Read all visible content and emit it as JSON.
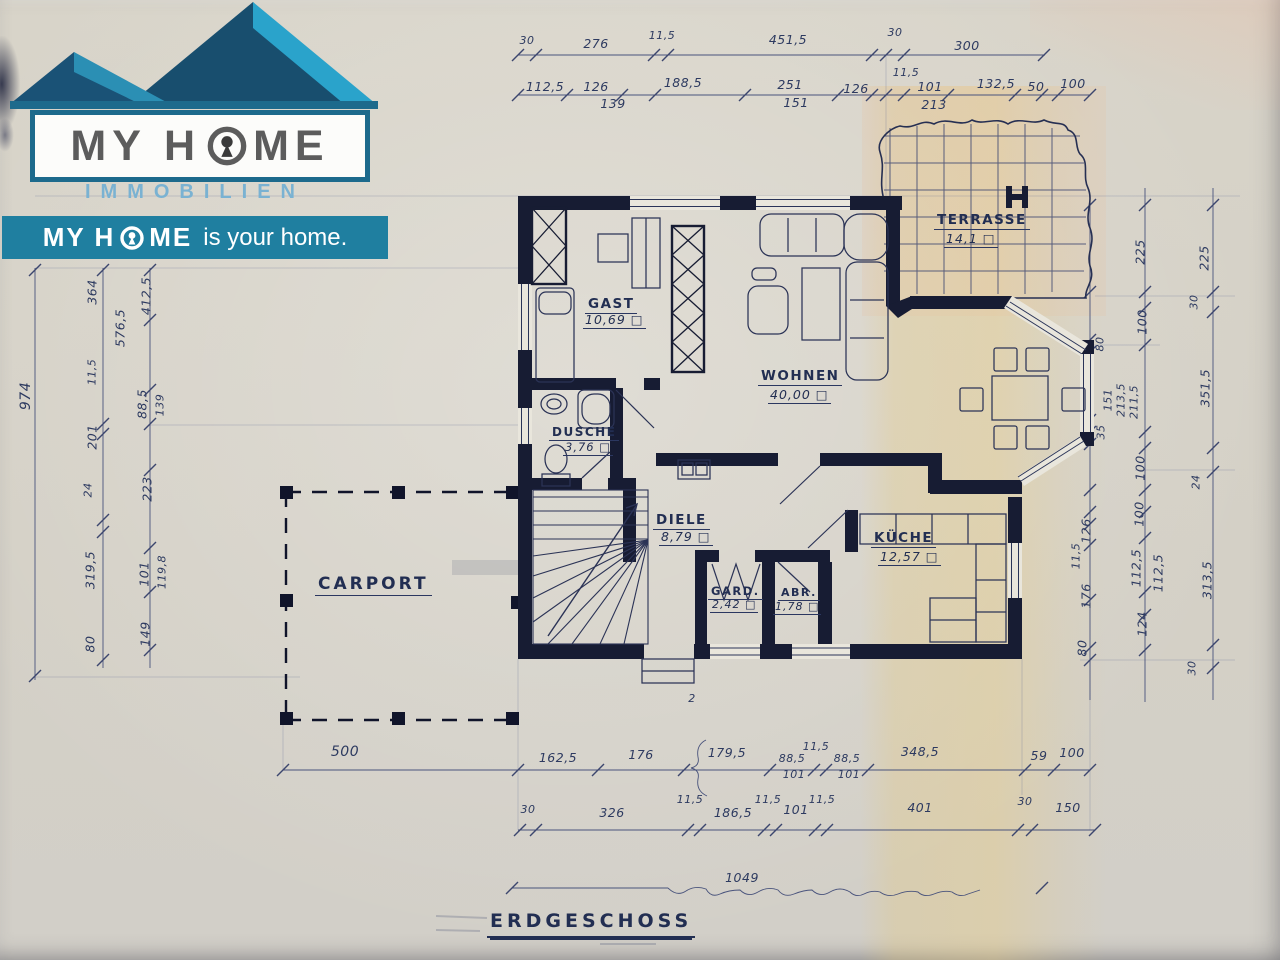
{
  "logo": {
    "brand_left": "MY H",
    "brand_right": "ME",
    "subtitle": "IMMOBILIEN",
    "tagline_prefix": "MY H",
    "tagline_mid": "ME",
    "tagline_suffix": "is your home.",
    "colors": {
      "roof_dark": "#1a5276",
      "roof_light": "#2ea1c9",
      "banner": "#1f7fa0"
    }
  },
  "plan": {
    "title": "ERDGESCHOSS",
    "rooms": {
      "gast": {
        "name": "GAST",
        "area": "10,69 □"
      },
      "wohnen": {
        "name": "WOHNEN",
        "area": "40,00 □"
      },
      "terrasse": {
        "name": "TERRASSE",
        "area": "14,1 □"
      },
      "dusche": {
        "name": "DUSCHE",
        "area": "3,76 □"
      },
      "diele": {
        "name": "DIELE",
        "area": "8,79 □"
      },
      "kueche": {
        "name": "KÜCHE",
        "area": "12,57 □"
      },
      "gard": {
        "name": "GARD.",
        "area": "2,42 □"
      },
      "abstell": {
        "name": "ABR.",
        "area": "1,78 □"
      },
      "carport": {
        "name": "CARPORT"
      }
    },
    "annotations": {
      "entry_mark": "2"
    },
    "dims": [
      "30",
      "276",
      "11,5",
      "451,5",
      "30",
      "300",
      "112,5",
      "126",
      "139",
      "188,5",
      "251",
      "151",
      "126",
      "11,5",
      "101",
      "213",
      "132,5",
      "50",
      "100",
      "974",
      "364",
      "11,5",
      "201",
      "24",
      "319,5",
      "80",
      "412,5",
      "576,5",
      "88,5",
      "139",
      "223",
      "101",
      "119,8",
      "149",
      "80",
      "151",
      "213,5",
      "211,5",
      "35",
      "126",
      "11,5",
      "176",
      "80",
      "225",
      "100",
      "100",
      "100",
      "112,5",
      "112,5",
      "124",
      "225",
      "30",
      "351,5",
      "24",
      "313,5",
      "30",
      "500",
      "162,5",
      "176",
      "179,5",
      "88,5",
      "101",
      "11,5",
      "88,5",
      "101",
      "348,5",
      "59",
      "100",
      "30",
      "326",
      "11,5",
      "186,5",
      "11,5",
      "101",
      "11,5",
      "401",
      "30",
      "150",
      "1049"
    ]
  }
}
